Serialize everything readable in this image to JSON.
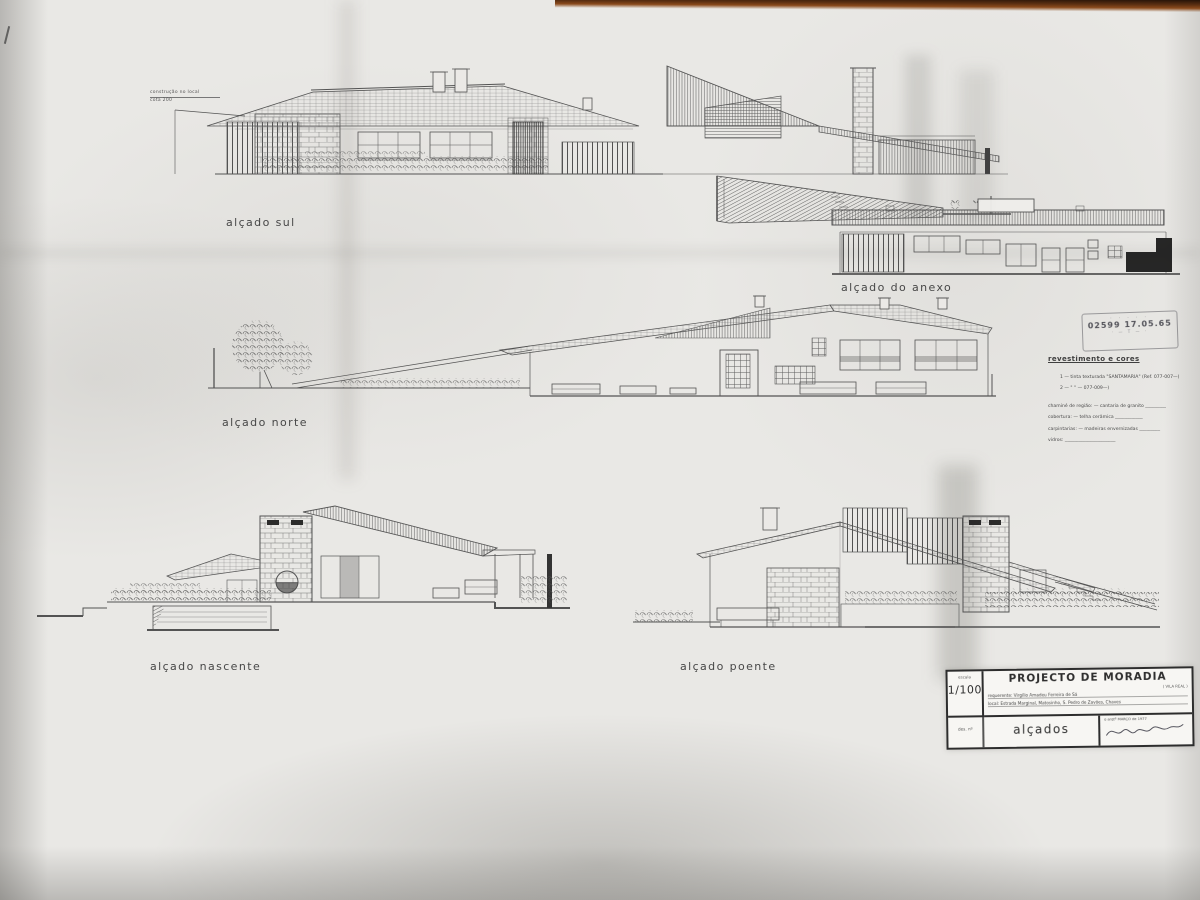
{
  "labels": {
    "sul": "alçado sul",
    "anexo": "alçado do anexo",
    "norte": "alçado norte",
    "nascente": "alçado nascente",
    "poente": "alçado poente"
  },
  "note": {
    "line1": "construção no local",
    "line2": "cota 200"
  },
  "stamp": {
    "line1": "· · · · ·",
    "line2": "02599   17.05.65",
    "line3": "· —  T  — ·"
  },
  "finishes": {
    "heading": "revestimento e cores",
    "lines": [
      "1 — tinta texturada \"SANTAMARIA\"   (Ref. 077-007—)",
      "2 —     \"          \"            —   077-009—)",
      "chaminé de região:   — cantaria de granito _________",
      "cobertura:   — telha cerâmica ____________",
      "carpintarias:   — madeiras envernizadas _________",
      "vidros: ______________________"
    ]
  },
  "titleblock": {
    "scale_label": "escala",
    "scale": "1/100",
    "sheet_no": "des. nº",
    "title": "PROJECTO DE MORADIA",
    "region": "( VILA REAL )",
    "requerente": "requerente:  Virgílio  Amadeu  Ferreira  de  Sá",
    "local": "local:   Estrada  Marginal,  Matosinho,  S. Pedro  de  Zavões,  Chaves",
    "drawing_name": "alçados",
    "date": "o arqtº   MARÇO  de  1977"
  }
}
